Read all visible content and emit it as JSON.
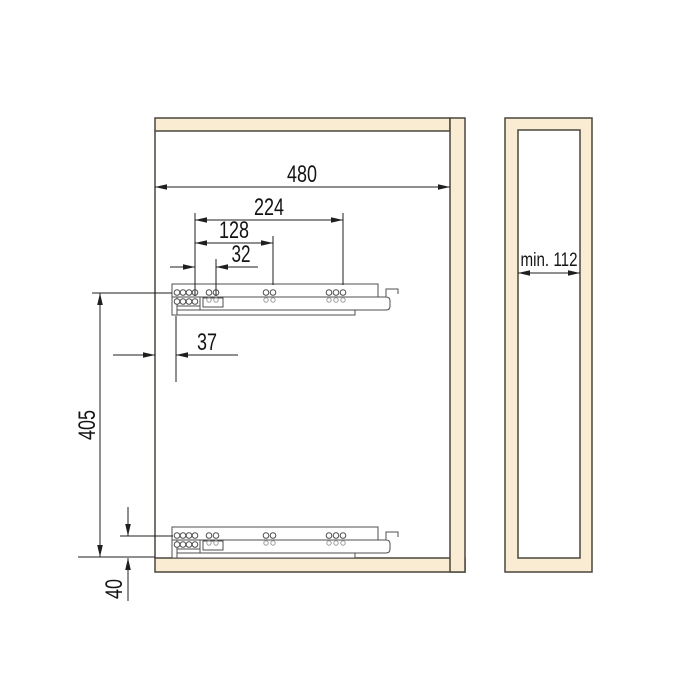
{
  "front_view": {
    "dim_width": "480",
    "dim_holes_outer": "224",
    "dim_holes_mid": "128",
    "dim_holes_first": "32",
    "dim_front_setback": "37",
    "dim_slide_spacing": "405",
    "dim_bottom_offset": "40"
  },
  "side_view": {
    "dim_depth_min": "min. 112"
  },
  "colors": {
    "panel_fill": "#f9ecd2",
    "panel_outline": "#4a473e",
    "slide_stroke": "#4f4f4f",
    "dimension_color": "#1f1f1f",
    "background": "#ffffff"
  }
}
